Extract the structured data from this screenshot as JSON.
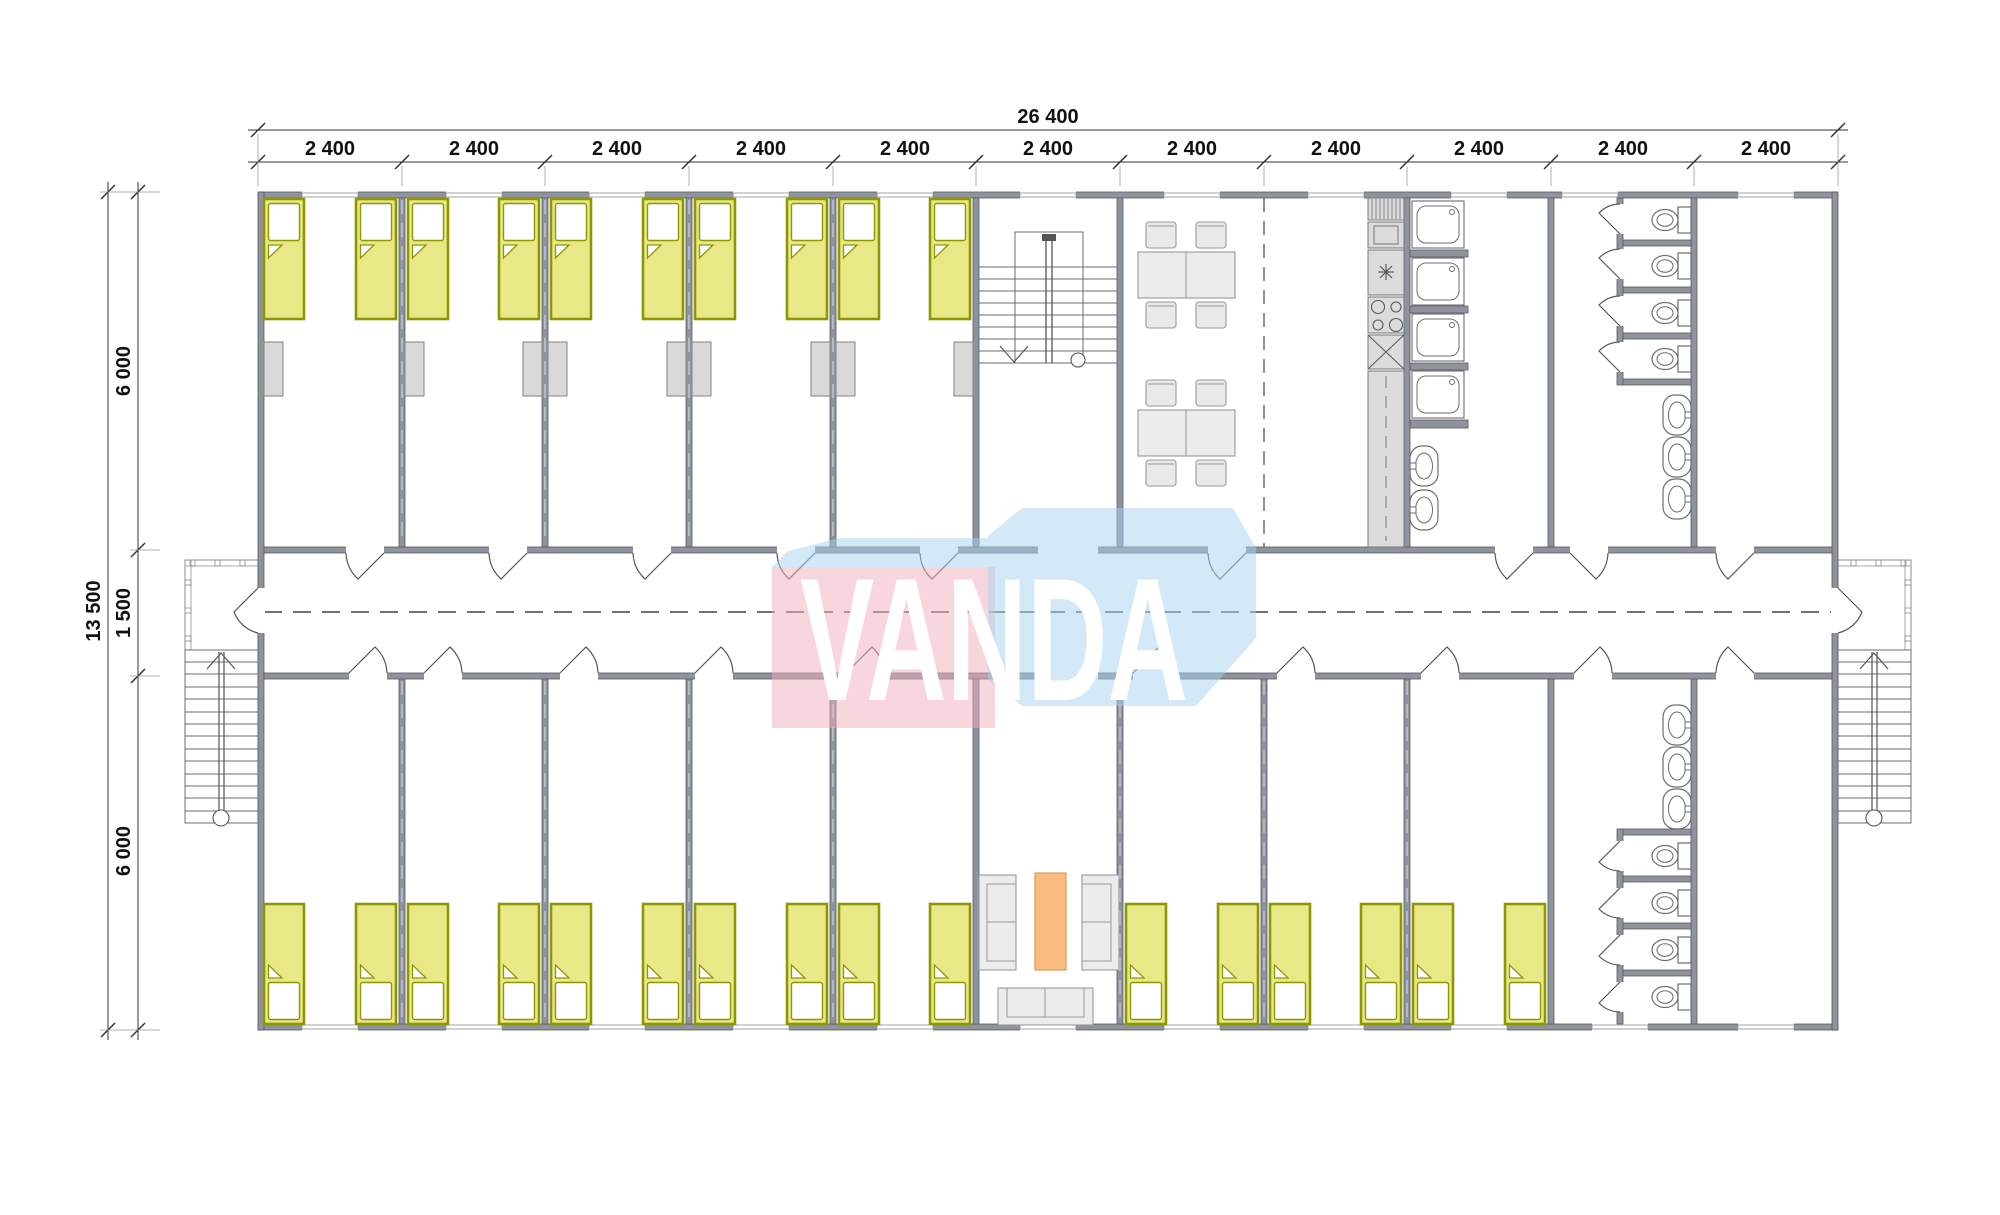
{
  "title": "dormitory-floor-plan",
  "watermark": {
    "text": "VANDA",
    "blue": "#a8d4f2",
    "pink": "#f2aebc"
  },
  "dims": {
    "top_total": "26 400",
    "top_segments": [
      "2 400",
      "2 400",
      "2 400",
      "2 400",
      "2 400",
      "2 400",
      "2 400",
      "2 400",
      "2 400",
      "2 400",
      "2 400"
    ],
    "left_total": "13 500",
    "left_segments": [
      "6 000",
      "1 500",
      "6 000"
    ]
  },
  "colors": {
    "wall": "#8f939c",
    "bed_fill": "#e9e887",
    "bed_border": "#8f9606",
    "locker": "#d9d9d9",
    "counter": "#dcdcdc",
    "lounge_table": "#f8bc80",
    "watermark_blue": "#a8d4f2",
    "watermark_pink": "#f2aebc"
  },
  "inventory": {
    "beds": 26,
    "lockers": 9,
    "dining_tables": 2,
    "dining_chairs": 8,
    "showers": 4,
    "wash_basins": 8,
    "toilets": 8,
    "sofas": 3,
    "staircases_internal": 1,
    "staircases_external": 2
  }
}
